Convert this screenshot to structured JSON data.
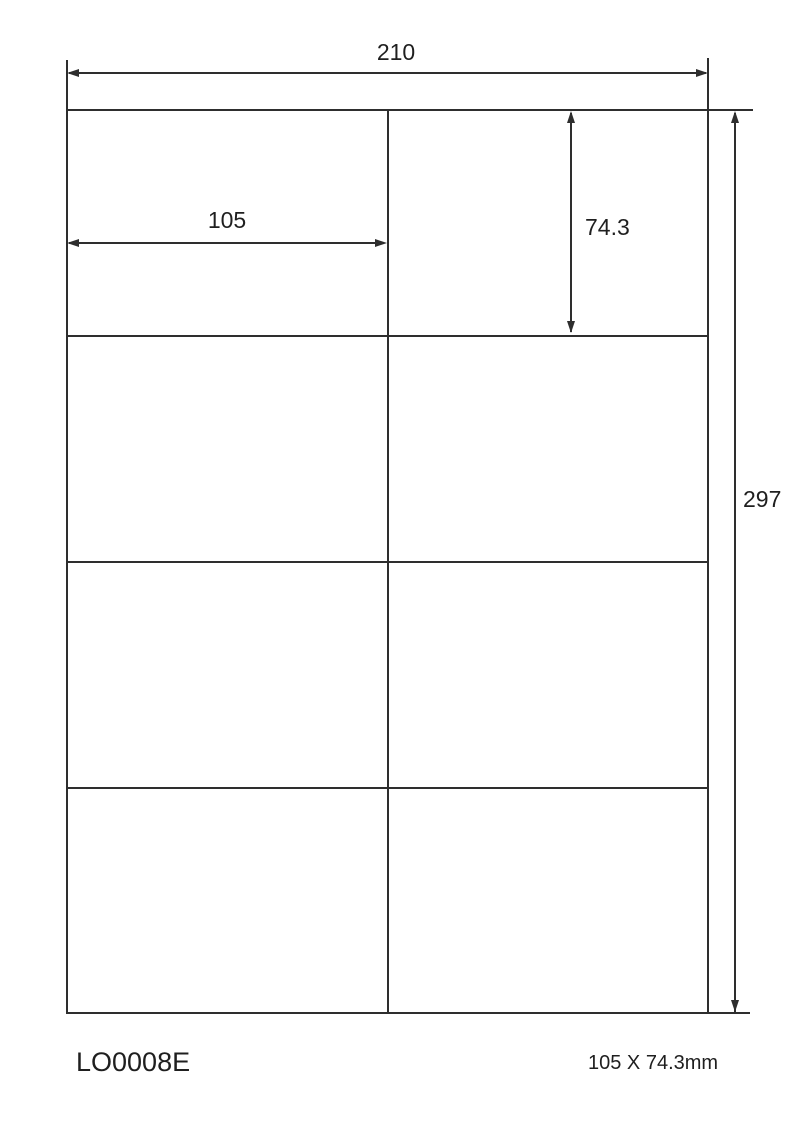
{
  "diagram": {
    "type": "label-sheet-dimension-diagram",
    "sheet_width_mm": "210",
    "sheet_height_mm": "297",
    "label_width_mm": "105",
    "label_height_mm": "74.3",
    "grid_rows": 4,
    "grid_columns": 2
  },
  "footer": {
    "product_code": "LO0008E",
    "label_size_text": "105 X 74.3mm"
  },
  "colors": {
    "line": "#2e2e2e",
    "text": "#1f1f1f",
    "background": "#ffffff"
  }
}
